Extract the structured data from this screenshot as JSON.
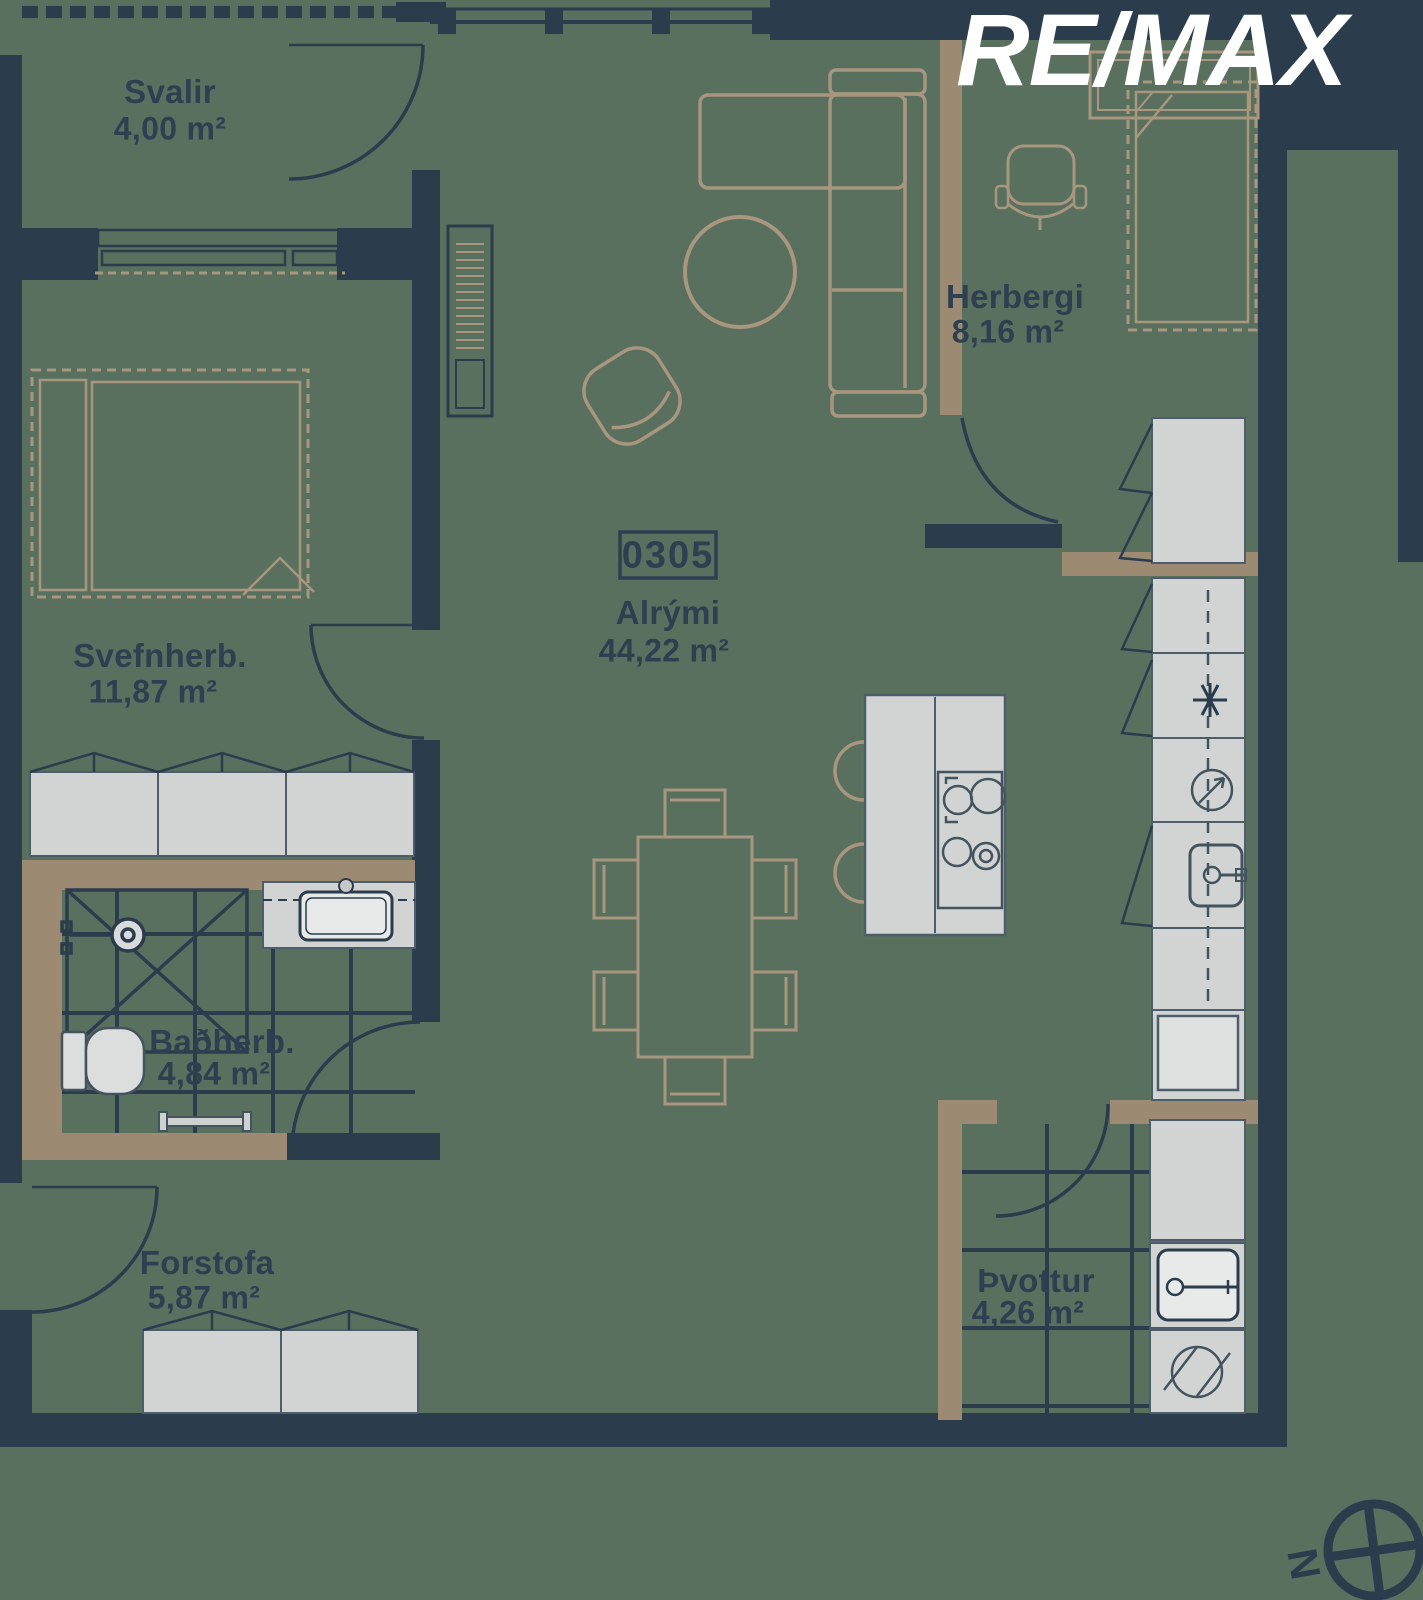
{
  "brand": {
    "logo_text": "RE/MAX"
  },
  "unit": {
    "number": "0305"
  },
  "rooms": [
    {
      "id": "svalir",
      "name": "Svalir",
      "area": "4,00 m²"
    },
    {
      "id": "svefnherb",
      "name": "Svefnherb.",
      "area": "11,87 m²"
    },
    {
      "id": "alrymi",
      "name": "Alrými",
      "area": "44,22 m²"
    },
    {
      "id": "herbergi",
      "name": "Herbergi",
      "area": "8,16 m²"
    },
    {
      "id": "badherb",
      "name": "Baðherb.",
      "area": "4,84 m²"
    },
    {
      "id": "forstofa",
      "name": "Forstofa",
      "area": "5,87 m²"
    },
    {
      "id": "thvottur",
      "name": "Þvottur",
      "area": "4,26 m²"
    }
  ],
  "compass": {
    "label": "N"
  },
  "colors": {
    "background": "#59705f",
    "wall": "#2b3c4d",
    "wood_wall": "#9c8a72",
    "furniture_outline": "#a8967e",
    "cabinet_fill": "#d2d4d3",
    "logo": "#ffffff"
  }
}
